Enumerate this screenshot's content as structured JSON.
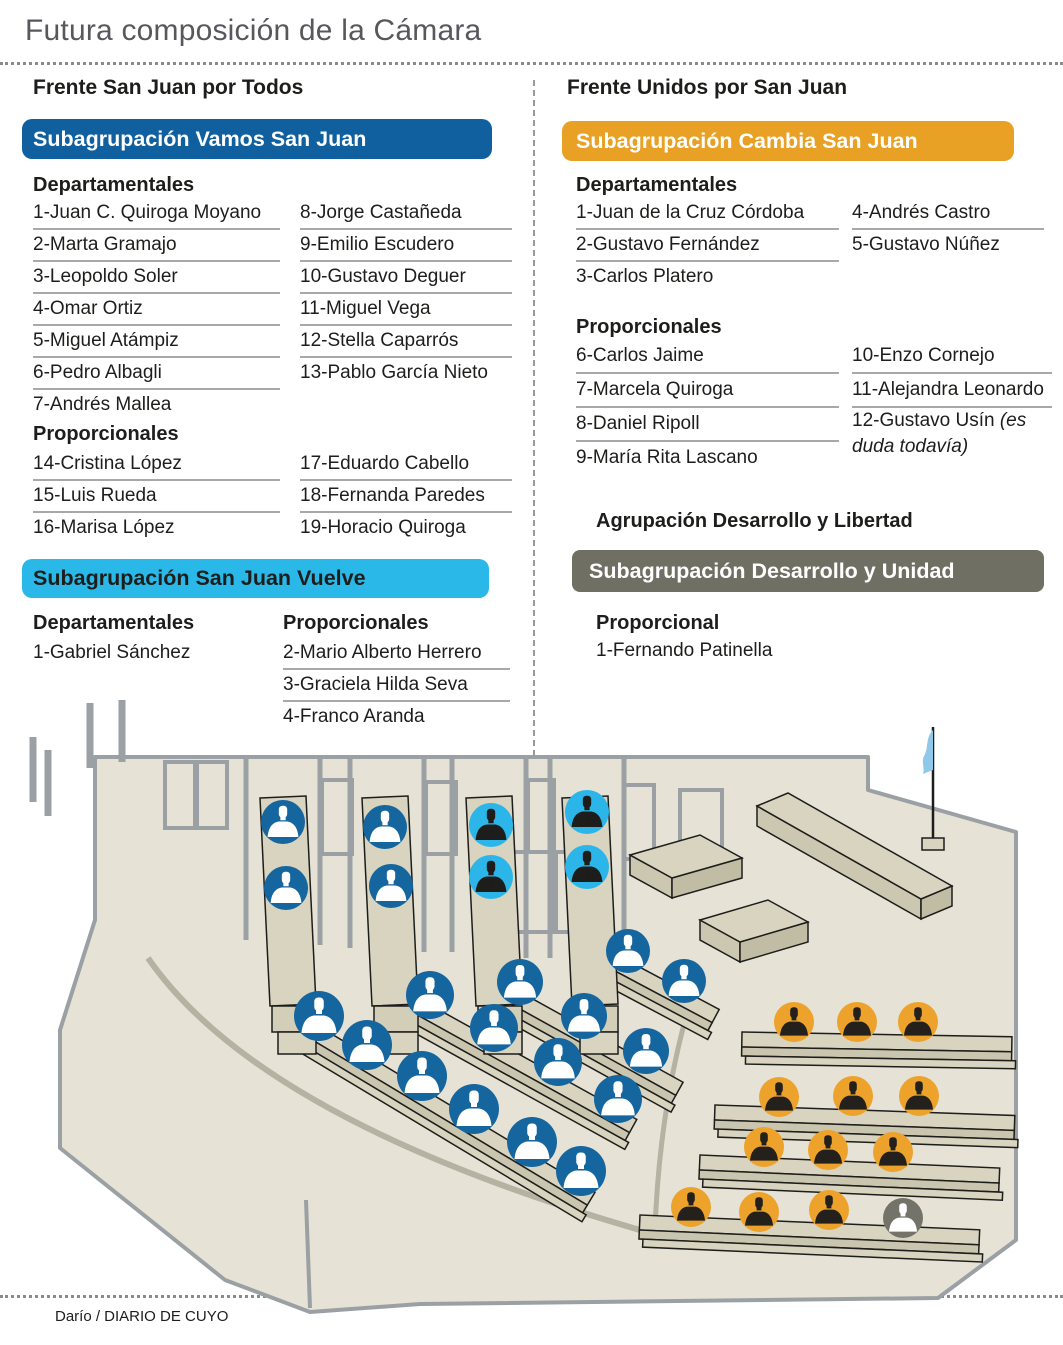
{
  "title": "Futura composición de la Cámara",
  "credit": "Darío / DIARIO DE CUYO",
  "colors": {
    "bar_blue": "#1060A0",
    "bar_cyan": "#29B8E8",
    "bar_orange": "#E9A125",
    "bar_gray": "#6F6F64",
    "vamos_bg": "#15659F",
    "vamos_fg": "#FFFFFF",
    "vuelve_bg": "#2BB5E9",
    "vuelve_fg": "#1D1D1B",
    "cambia_bg": "#EDA22B",
    "cambia_fg": "#24211C",
    "desarrollo_bg": "#73736A",
    "desarrollo_fg": "#FFFFFF"
  },
  "left": {
    "frente": "Frente San Juan por Todos",
    "vamos": {
      "header": "Subagrupación Vamos San Juan",
      "dep_label": "Departamentales",
      "prop_label": "Proporcionales",
      "dep_col1": [
        "1-Juan C. Quiroga Moyano",
        "2-Marta Gramajo",
        "3-Leopoldo Soler",
        "4-Omar Ortiz",
        "5-Miguel Atámpiz",
        "6-Pedro Albagli",
        "7-Andrés Mallea"
      ],
      "dep_col2": [
        "8-Jorge Castañeda",
        "9-Emilio Escudero",
        "10-Gustavo Deguer",
        "11-Miguel Vega",
        "12-Stella Caparrós",
        "13-Pablo García Nieto"
      ],
      "prop_col1": [
        "14-Cristina López",
        "15-Luis Rueda",
        "16-Marisa López"
      ],
      "prop_col2": [
        "17-Eduardo Cabello",
        "18-Fernanda Paredes",
        "19-Horacio Quiroga"
      ]
    },
    "vuelve": {
      "header": "Subagrupación San Juan Vuelve",
      "dep_label": "Departamentales",
      "prop_label": "Proporcionales",
      "dep": [
        "1-Gabriel Sánchez"
      ],
      "prop": [
        "2-Mario Alberto Herrero",
        "3-Graciela Hilda Seva",
        "4-Franco Aranda"
      ]
    }
  },
  "right": {
    "frente": "Frente Unidos por San Juan",
    "cambia": {
      "header": "Subagrupación Cambia San Juan",
      "dep_label": "Departamentales",
      "prop_label": "Proporcionales",
      "dep_col1": [
        "1-Juan de la Cruz Córdoba",
        "2-Gustavo Fernández",
        "3-Carlos Platero"
      ],
      "dep_col2": [
        "4-Andrés Castro",
        "5-Gustavo Núñez"
      ],
      "prop_col1": [
        "6-Carlos Jaime",
        "7-Marcela Quiroga",
        "8-Daniel Ripoll",
        "9-María Rita Lascano"
      ],
      "prop_col2": [
        "10-Enzo Cornejo",
        "11-Alejandra Leonardo"
      ],
      "prop_col2_last_main": "12-Gustavo Usín ",
      "prop_col2_last_note": "(es duda todavía)"
    },
    "desarrollo": {
      "agrupacion": "Agrupación Desarrollo y Libertad",
      "header": "Subagrupación Desarrollo y Unidad",
      "prop_label": "Proporcional",
      "member": "1-Fernando Patinella"
    }
  },
  "chamber": {
    "icon": "person-bust-icon",
    "seat_counts": {
      "vamos": 19,
      "vuelve": 4,
      "cambia": 12,
      "desarrollo": 1
    },
    "seats": [
      {
        "party": "vamos",
        "x": 283,
        "y": 822,
        "r": 22
      },
      {
        "party": "vamos",
        "x": 286,
        "y": 888,
        "r": 22
      },
      {
        "party": "vamos",
        "x": 385,
        "y": 827,
        "r": 22
      },
      {
        "party": "vamos",
        "x": 391,
        "y": 886,
        "r": 22
      },
      {
        "party": "vuelve",
        "x": 491,
        "y": 825,
        "r": 22
      },
      {
        "party": "vuelve",
        "x": 491,
        "y": 877,
        "r": 22
      },
      {
        "party": "vuelve",
        "x": 587,
        "y": 812,
        "r": 22
      },
      {
        "party": "vuelve",
        "x": 587,
        "y": 867,
        "r": 22
      },
      {
        "party": "vamos",
        "x": 628,
        "y": 951,
        "r": 22
      },
      {
        "party": "vamos",
        "x": 684,
        "y": 981,
        "r": 22
      },
      {
        "party": "vamos",
        "x": 520,
        "y": 982,
        "r": 23
      },
      {
        "party": "vamos",
        "x": 584,
        "y": 1016,
        "r": 23
      },
      {
        "party": "vamos",
        "x": 646,
        "y": 1051,
        "r": 23
      },
      {
        "party": "vamos",
        "x": 430,
        "y": 995,
        "r": 24
      },
      {
        "party": "vamos",
        "x": 494,
        "y": 1028,
        "r": 24
      },
      {
        "party": "vamos",
        "x": 558,
        "y": 1062,
        "r": 24
      },
      {
        "party": "vamos",
        "x": 618,
        "y": 1099,
        "r": 24
      },
      {
        "party": "vamos",
        "x": 319,
        "y": 1016,
        "r": 25
      },
      {
        "party": "vamos",
        "x": 367,
        "y": 1045,
        "r": 25
      },
      {
        "party": "vamos",
        "x": 422,
        "y": 1076,
        "r": 25
      },
      {
        "party": "vamos",
        "x": 474,
        "y": 1109,
        "r": 25
      },
      {
        "party": "vamos",
        "x": 532,
        "y": 1142,
        "r": 25
      },
      {
        "party": "vamos",
        "x": 581,
        "y": 1171,
        "r": 25
      },
      {
        "party": "cambia",
        "x": 794,
        "y": 1022,
        "r": 20
      },
      {
        "party": "cambia",
        "x": 857,
        "y": 1022,
        "r": 20
      },
      {
        "party": "cambia",
        "x": 918,
        "y": 1022,
        "r": 20
      },
      {
        "party": "cambia",
        "x": 779,
        "y": 1097,
        "r": 20
      },
      {
        "party": "cambia",
        "x": 853,
        "y": 1096,
        "r": 20
      },
      {
        "party": "cambia",
        "x": 919,
        "y": 1096,
        "r": 20
      },
      {
        "party": "cambia",
        "x": 764,
        "y": 1147,
        "r": 20
      },
      {
        "party": "cambia",
        "x": 828,
        "y": 1150,
        "r": 20
      },
      {
        "party": "cambia",
        "x": 893,
        "y": 1152,
        "r": 20
      },
      {
        "party": "cambia",
        "x": 691,
        "y": 1207,
        "r": 20
      },
      {
        "party": "cambia",
        "x": 759,
        "y": 1212,
        "r": 20
      },
      {
        "party": "cambia",
        "x": 829,
        "y": 1210,
        "r": 20
      },
      {
        "party": "desarrollo",
        "x": 903,
        "y": 1218,
        "r": 20
      }
    ]
  }
}
